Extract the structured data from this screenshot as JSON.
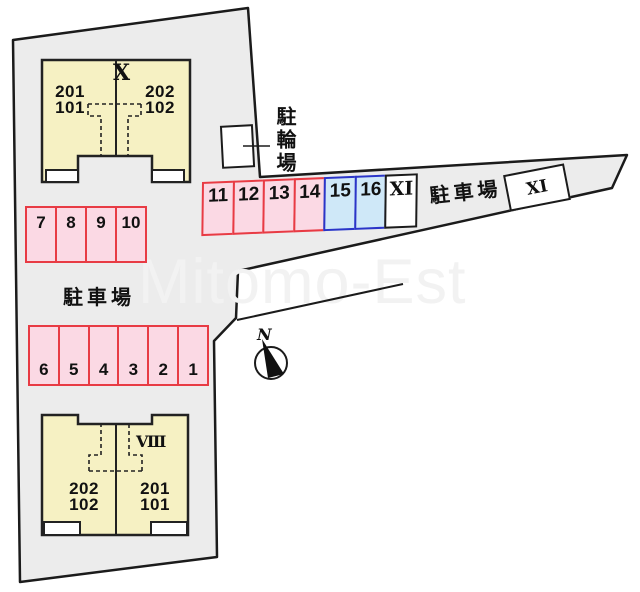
{
  "watermark": "Mitomo-Est",
  "compass": {
    "north_label": "N"
  },
  "labels": {
    "parking_area_left": "駐車場",
    "parking_area_right": "駐車場",
    "bicycle_parking": "駐輪場"
  },
  "buildings": {
    "top": {
      "label": "X",
      "left_unit_line1": "201",
      "left_unit_line2": "101",
      "right_unit_line1": "202",
      "right_unit_line2": "102"
    },
    "bottom": {
      "label": "VIII",
      "left_unit_line1": "202",
      "left_unit_line2": "102",
      "right_unit_line1": "201",
      "right_unit_line2": "101"
    }
  },
  "parking": {
    "row_top": [
      "7",
      "8",
      "9",
      "10"
    ],
    "row_middle": [
      "11",
      "12",
      "13",
      "14",
      "15",
      "16",
      "XI"
    ],
    "row_bottom": [
      "6",
      "5",
      "4",
      "3",
      "2",
      "1"
    ],
    "detached_space": "XI"
  },
  "colors": {
    "site_fill": "#ececec",
    "outline": "#1b1b1b",
    "building_fill": "#f6f1c3",
    "space_pink_fill": "#fbd9e4",
    "space_pink_border": "#e83b44",
    "space_blue_fill": "#cfe8f8",
    "space_blue_border": "#2b35c8"
  }
}
